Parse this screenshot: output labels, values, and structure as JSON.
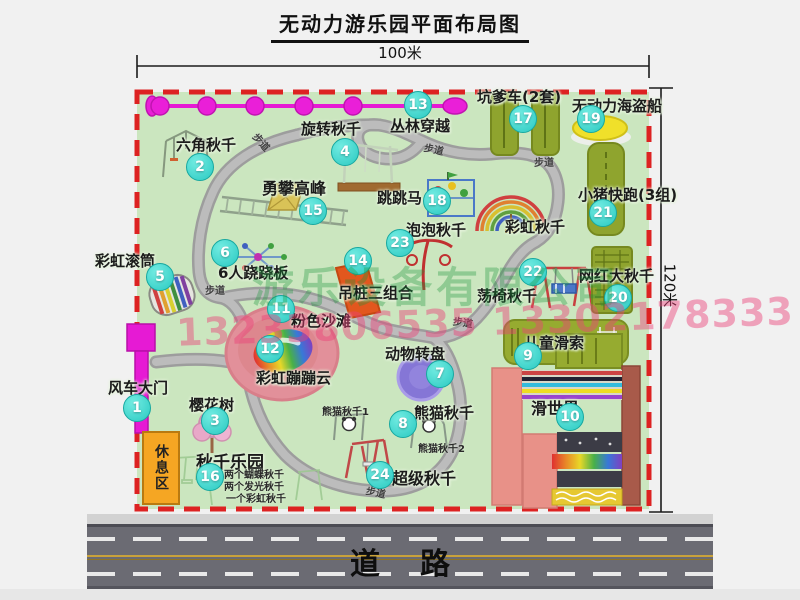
{
  "title": "无动力游乐园平面布局图",
  "dimensions": {
    "top": "100米",
    "right": "120米"
  },
  "road": {
    "label": "道路"
  },
  "rest_area": {
    "label": "休息区"
  },
  "watermark": {
    "company": "游乐设备有限公司",
    "phone": "13233806535 13302178333"
  },
  "walkway": {
    "label": "步道",
    "spots": [
      {
        "x": 252,
        "y": 134,
        "r": 48
      },
      {
        "x": 424,
        "y": 141,
        "r": 12
      },
      {
        "x": 534,
        "y": 154,
        "r": 0
      },
      {
        "x": 205,
        "y": 282,
        "r": 0
      },
      {
        "x": 453,
        "y": 314,
        "r": 8
      },
      {
        "x": 366,
        "y": 484,
        "r": 12
      }
    ]
  },
  "attractions": [
    {
      "num": "1",
      "label": "风车大门",
      "bx": 137,
      "by": 408,
      "lx": 108,
      "ly": 377,
      "fs": 15
    },
    {
      "num": "2",
      "label": "六角秋千",
      "bx": 200,
      "by": 167,
      "lx": 176,
      "ly": 134,
      "fs": 15
    },
    {
      "num": "3",
      "label": "樱花树",
      "bx": 215,
      "by": 421,
      "lx": 189,
      "ly": 394,
      "fs": 15
    },
    {
      "num": "4",
      "label": "旋转秋千",
      "bx": 345,
      "by": 152,
      "lx": 301,
      "ly": 118,
      "fs": 15
    },
    {
      "num": "5",
      "label": "彩虹滚筒",
      "bx": 160,
      "by": 277,
      "lx": 95,
      "ly": 250,
      "fs": 15
    },
    {
      "num": "6",
      "label": "6人跷跷板",
      "bx": 225,
      "by": 253,
      "lx": 218,
      "ly": 262,
      "fs": 15
    },
    {
      "num": "7",
      "label": "动物转盘",
      "bx": 440,
      "by": 374,
      "lx": 385,
      "ly": 343,
      "fs": 15
    },
    {
      "num": "8",
      "label": "熊猫秋千",
      "bx": 403,
      "by": 424,
      "lx": 414,
      "ly": 402,
      "fs": 15,
      "subs": [
        {
          "text": "熊猫秋千1",
          "x": 322,
          "y": 403
        },
        {
          "text": "熊猫秋千2",
          "x": 418,
          "y": 440
        }
      ]
    },
    {
      "num": "9",
      "label": "儿童滑索",
      "bx": 528,
      "by": 356,
      "lx": 524,
      "ly": 332,
      "fs": 15
    },
    {
      "num": "10",
      "label": "滑世界",
      "bx": 570,
      "by": 417,
      "lx": 531,
      "ly": 395,
      "fs": 16
    },
    {
      "num": "11",
      "label": "粉色沙滩",
      "bx": 281,
      "by": 309,
      "lx": 291,
      "ly": 310,
      "fs": 15
    },
    {
      "num": "12",
      "label": "彩虹蹦蹦云",
      "bx": 270,
      "by": 349,
      "lx": 256,
      "ly": 367,
      "fs": 15
    },
    {
      "num": "13",
      "label": "丛林穿越",
      "bx": 418,
      "by": 105,
      "lx": 390,
      "ly": 115,
      "fs": 15
    },
    {
      "num": "14",
      "label": "吊桩三组合",
      "bx": 358,
      "by": 261,
      "lx": 338,
      "ly": 282,
      "fs": 15
    },
    {
      "num": "15",
      "label": "勇攀高峰",
      "bx": 313,
      "by": 211,
      "lx": 262,
      "ly": 175,
      "fs": 16
    },
    {
      "num": "16",
      "label": "秋千乐园",
      "bx": 210,
      "by": 477,
      "lx": 196,
      "ly": 448,
      "fs": 17,
      "subs": [
        {
          "text": "两个蝴蝶秋千",
          "x": 224,
          "y": 466
        },
        {
          "text": "两个发光秋千",
          "x": 224,
          "y": 478
        },
        {
          "text": "一个彩虹秋千",
          "x": 226,
          "y": 490
        }
      ]
    },
    {
      "num": "17",
      "label": "坑爹车(2套)",
      "bx": 523,
      "by": 119,
      "lx": 477,
      "ly": 86,
      "fs": 15
    },
    {
      "num": "18",
      "label": "跳跳马",
      "bx": 437,
      "by": 201,
      "lx": 377,
      "ly": 187,
      "fs": 15
    },
    {
      "num": "19",
      "label": "无动力海盗船",
      "bx": 591,
      "by": 119,
      "lx": 572,
      "ly": 95,
      "fs": 15
    },
    {
      "num": "20",
      "label": "网红大秋千",
      "bx": 618,
      "by": 298,
      "lx": 579,
      "ly": 265,
      "fs": 15
    },
    {
      "num": "21",
      "label": "小猪快跑(3组)",
      "bx": 603,
      "by": 213,
      "lx": 578,
      "ly": 184,
      "fs": 15
    },
    {
      "num": "22",
      "label": "荡椅秋千",
      "bx": 533,
      "by": 272,
      "lx": 477,
      "ly": 285,
      "fs": 15
    },
    {
      "num": "23",
      "label": "泡泡秋千",
      "bx": 400,
      "by": 243,
      "lx": 406,
      "ly": 219,
      "fs": 15
    },
    {
      "num": "24",
      "label": "超级秋千",
      "bx": 380,
      "by": 475,
      "lx": 392,
      "ly": 465,
      "fs": 16
    }
  ],
  "extra_labels": [
    {
      "text": "彩虹秋千",
      "x": 505,
      "y": 216,
      "fs": 15
    }
  ],
  "colors": {
    "map_bg": "#cbe6bf",
    "border_red": "#dd2222",
    "badge_teal": "#2bc9c1",
    "gate_magenta": "#e61ad4",
    "olive_green": "#92a72f",
    "salmon": "#e89188",
    "road_gray": "#6b6b73",
    "rest_orange": "#f5a623"
  }
}
